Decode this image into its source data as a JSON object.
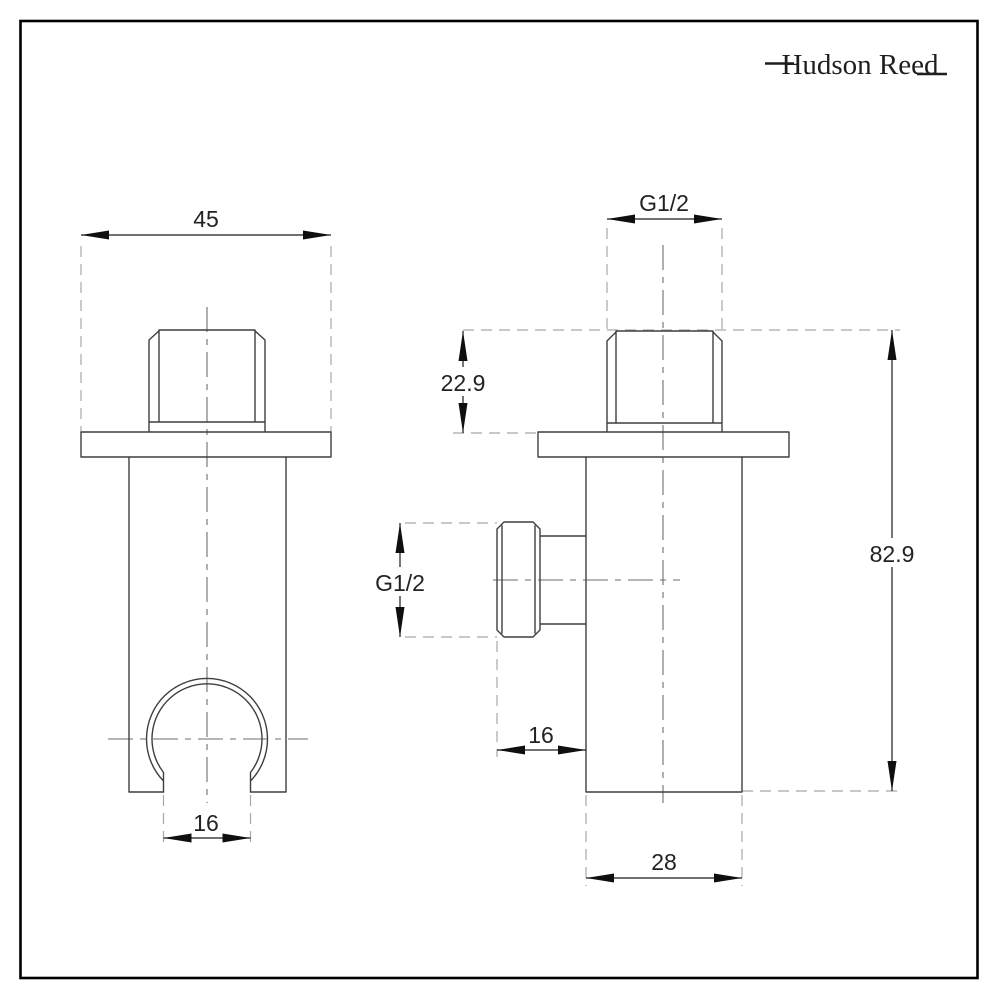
{
  "brand": {
    "name": "Hudson Reed"
  },
  "page": {
    "background": "#ffffff",
    "border_color": "#000000"
  },
  "drawing": {
    "kind": "technical-dimension-drawing",
    "subject": "shower handset wall bracket with outlet elbow, front and side views",
    "colors": {
      "solid_line": "#3f3f3f",
      "dimension_line": "#1c1c1c",
      "extension_line": "#a8a8a8",
      "centerline": "#6e6e6e",
      "text": "#222222"
    },
    "front_view": {
      "dimensions": {
        "overall_width": "45",
        "opening_width": "16"
      }
    },
    "side_view": {
      "dimensions": {
        "top_thread": "G1/2",
        "thread_length": "22.9",
        "overall_height": "82.9",
        "side_thread": "G1/2",
        "outlet_offset": "16",
        "body_depth": "28"
      }
    }
  }
}
